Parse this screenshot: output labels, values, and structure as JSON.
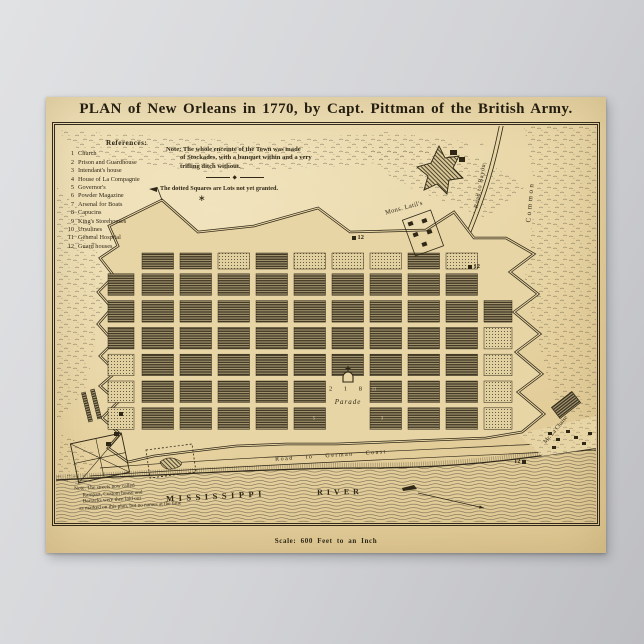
{
  "poster": {
    "title": "PLAN of New Orleans in 1770, by Capt. Pittman of the British Army.",
    "scale_label": "Scale: 600 Feet to an Inch",
    "references": {
      "heading": "References:",
      "items": [
        {
          "num": "1",
          "label": "Church"
        },
        {
          "num": "2",
          "label": "Prison and Guardhouse"
        },
        {
          "num": "3",
          "label": "Intendant's house"
        },
        {
          "num": "4",
          "label": "House of La Compagnie"
        },
        {
          "num": "5",
          "label": "Governor's"
        },
        {
          "num": "6",
          "label": "Powder Magazine"
        },
        {
          "num": "7",
          "label": "Arsenal for Boats"
        },
        {
          "num": "8",
          "label": "Capucins"
        },
        {
          "num": "9",
          "label": "King's Storehouses"
        },
        {
          "num": "10",
          "label": "Ursulines"
        },
        {
          "num": "11",
          "label": "General Hospital"
        },
        {
          "num": "12",
          "label": "Guard houses"
        }
      ]
    },
    "note": {
      "line1": "Note: The whole enceinte of the Town was made",
      "line2": "of Stockades, with a banquet within and a very",
      "line3": "trifling ditch without.",
      "dotted_squares": "The dotted Squares are Lots not yet granted."
    },
    "map_labels": {
      "mons_latils": "Mons. Latil's",
      "road_to_bayou": "Road to Bayou",
      "common": "Common",
      "road_to_german_coast": "Road to German Coast",
      "mr_la_chaise": "Mr. La Chaise",
      "mississippi": "MISSISSIPPI",
      "river": "RIVER",
      "parade": "Parade",
      "parade_numbers": "2 1 8",
      "marker_top": "12",
      "marker_right": "12",
      "marker_bottom": "12",
      "block_numbers": [
        "5",
        "3",
        "3",
        "11"
      ],
      "star_ornament": "∗"
    },
    "bottom_note": {
      "line1": "Note: The streets now called",
      "line2": "Rampart, Custom house and",
      "line3": "Barracks were then laid out",
      "line4": "as marked on this plan, but no names at the time"
    },
    "colors": {
      "background": "#d2d3d6",
      "paper": "#e8d5a5",
      "ink": "#2f2817"
    }
  }
}
